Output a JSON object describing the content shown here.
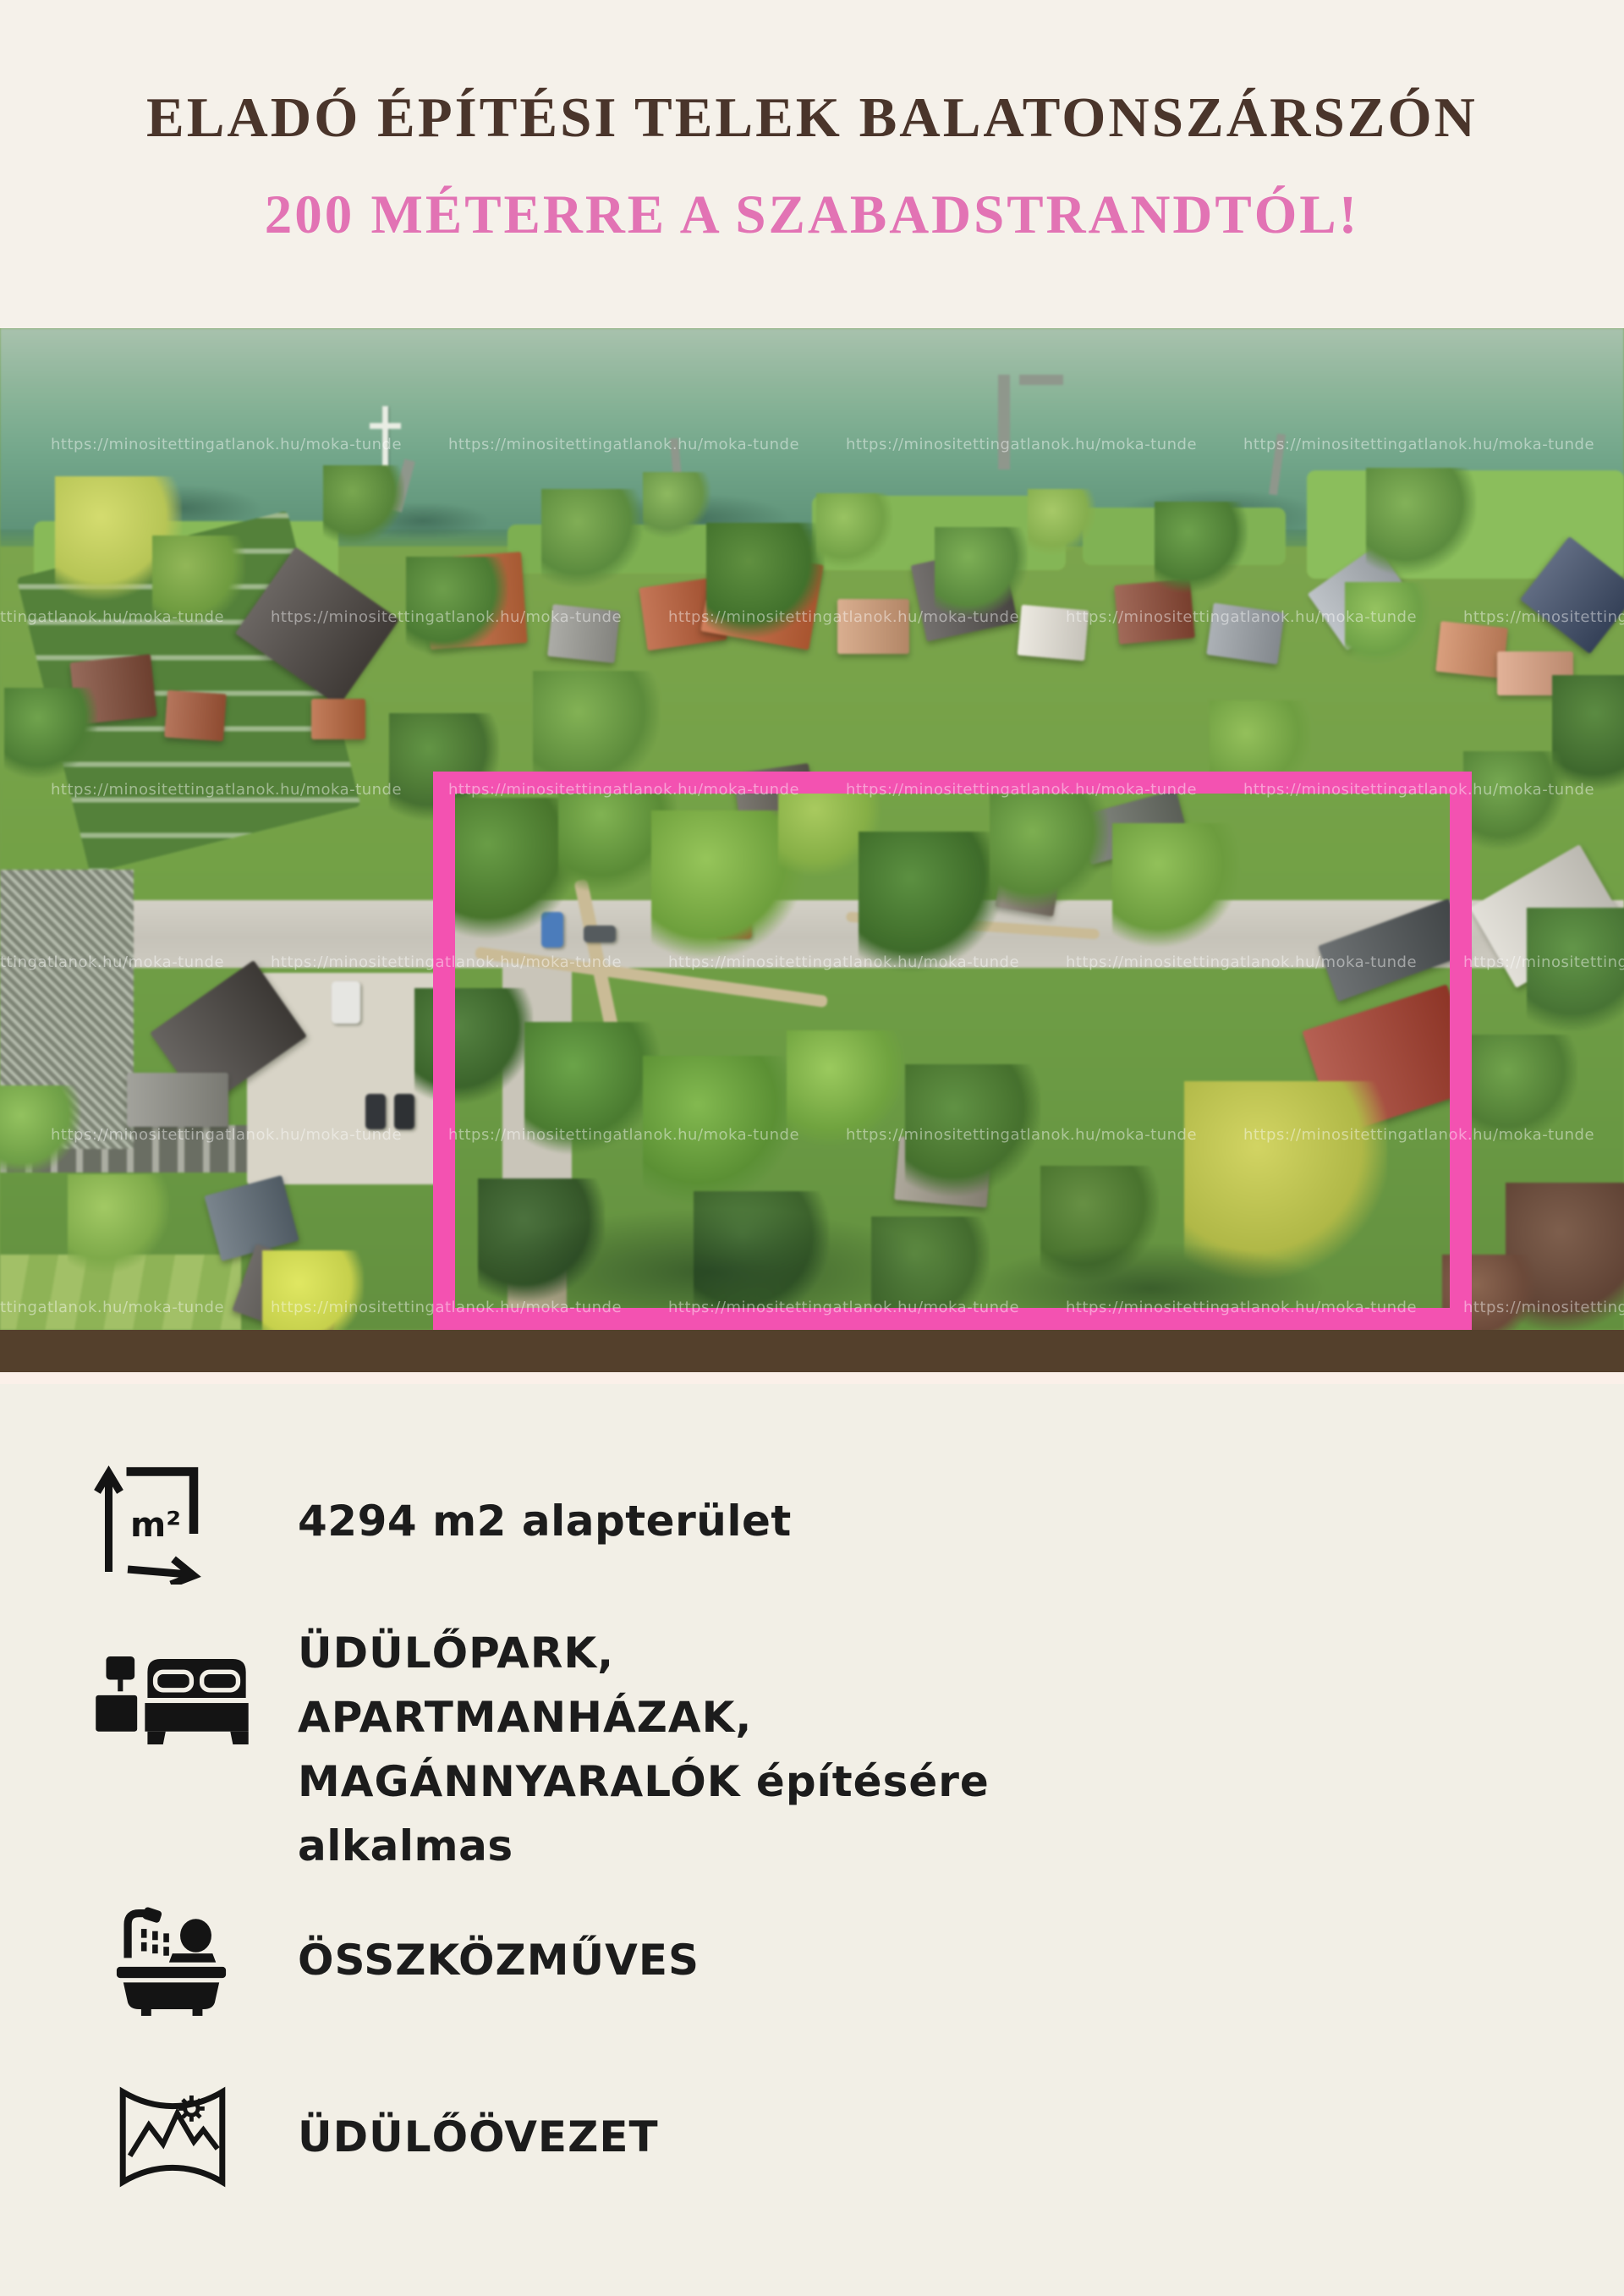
{
  "header": {
    "title": "ELADÓ ÉPÍTÉSI TELEK BALATONSZÁRSZÓN",
    "subtitle": "200 MÉTERRE A SZABADSTRANDTÓL!",
    "title_color": "#4a352b",
    "subtitle_color": "#e273b4"
  },
  "photo": {
    "watermark": "https://minositettingatlanok.hu/moka-tunde",
    "plot_outline_color": "#f352b1"
  },
  "features": [
    {
      "icon": "area-measure-icon",
      "label": "4294 m2 alapterület"
    },
    {
      "icon": "bed-icon",
      "lines": [
        "ÜDÜLŐPARK,",
        "APARTMANHÁZAK,",
        "MAGÁNNYARALÓK építésére",
        "alkalmas"
      ]
    },
    {
      "icon": "bathtub-shower-icon",
      "label": "ÖSSZKÖZMŰVES"
    },
    {
      "icon": "map-landscape-icon",
      "label": "ÜDÜLŐÖVEZET"
    }
  ]
}
